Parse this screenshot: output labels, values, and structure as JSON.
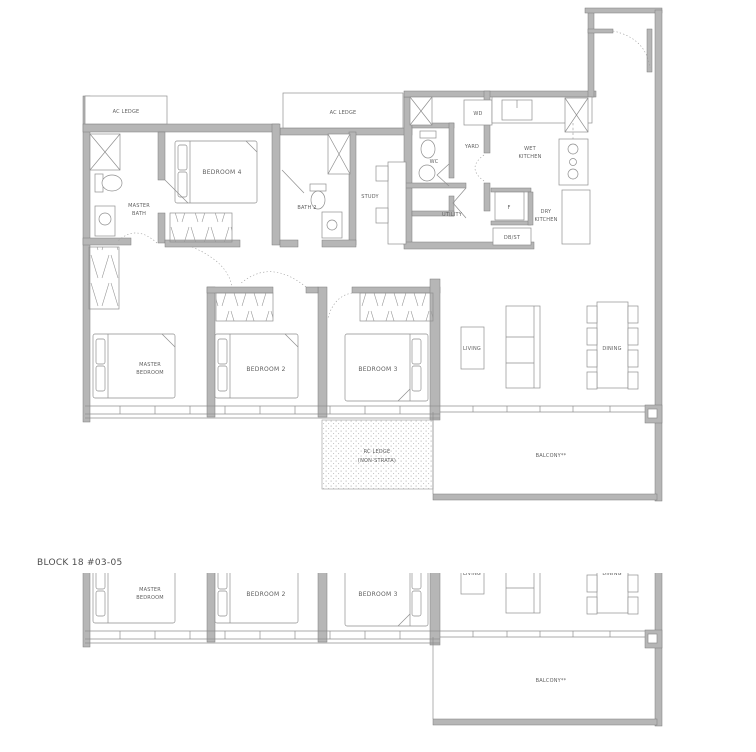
{
  "title": "BLOCK 18 #03-05",
  "colors": {
    "wall": "#b6b6b6",
    "wallstroke": "#7d7d7d",
    "line": "#8f8f8f",
    "text": "#5f5f5f"
  },
  "labels": {
    "ac_ledge_left": "AC LEDGE",
    "ac_ledge_mid": "AC LEDGE",
    "master_bath_1": "MASTER",
    "master_bath_2": "BATH",
    "bedroom4": "BEDROOM 4",
    "bath2": "BATH 2",
    "study": "STUDY",
    "wc": "WC",
    "yard": "YARD",
    "wd": "WD",
    "wet_kitchen_1": "WET",
    "wet_kitchen_2": "KITCHEN",
    "utility": "UTILITY",
    "fridge": "F",
    "dry_kitchen_1": "DRY",
    "dry_kitchen_2": "KITCHEN",
    "db_st": "DB/ST",
    "master_bedroom_1": "MASTER",
    "master_bedroom_2": "BEDROOM",
    "bedroom2": "BEDROOM 2",
    "bedroom3": "BEDROOM 3",
    "living": "LIVING",
    "dining": "DINING",
    "balcony": "BALCONY**",
    "rc_ledge_1": "RC LEDGE",
    "rc_ledge_2": "(NON-STRATA)"
  }
}
